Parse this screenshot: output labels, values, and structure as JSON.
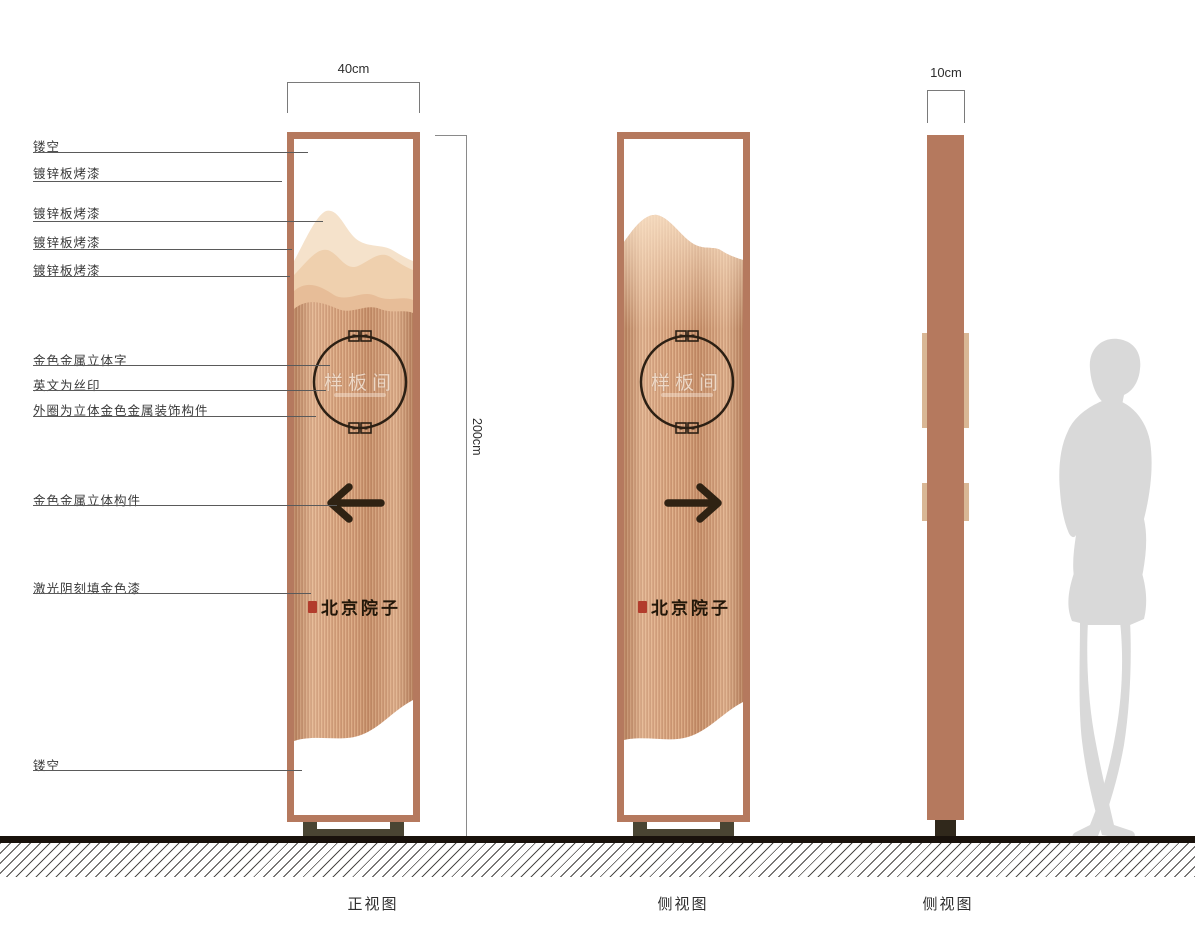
{
  "annotations": [
    {
      "label": "镂空"
    },
    {
      "label": "镀锌板烤漆"
    },
    {
      "label": "镀锌板烤漆"
    },
    {
      "label": "镀锌板烤漆"
    },
    {
      "label": "镀锌板烤漆"
    },
    {
      "label": "金色金属立体字"
    },
    {
      "label": "英文为丝印"
    },
    {
      "label": "外圈为立体金色金属装饰构件"
    },
    {
      "label": "金色金属立体构件"
    },
    {
      "label": "激光阴刻填金色漆"
    },
    {
      "label": "镂空"
    }
  ],
  "dimensions": {
    "width": "40cm",
    "height": "200cm",
    "depth": "10cm"
  },
  "sign": {
    "circle_text": "样板间",
    "brand_text": "北京院子"
  },
  "view_labels": [
    "正视图",
    "侧视图",
    "侧视图"
  ],
  "colors": {
    "frame": "#b5795e",
    "body_base": "#d29a75",
    "mountain_light": "#f5e2cb",
    "mountain_mid": "#efd0ae",
    "mountain_deep": "#e7bd98",
    "ink": "#2c2014",
    "seal_red": "#b23c2c",
    "stand": "#4a4533",
    "ground": "#19120c",
    "silhouette": "#d9d9d9"
  }
}
